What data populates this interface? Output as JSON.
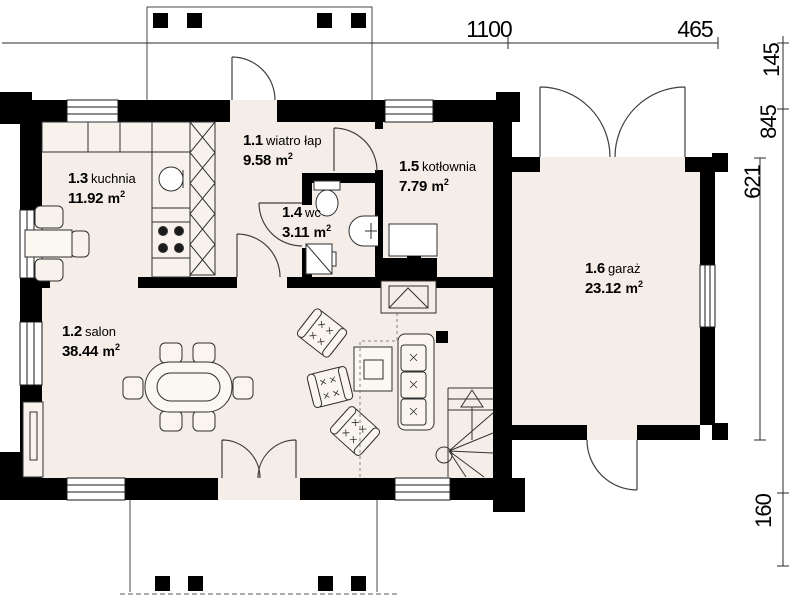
{
  "plan": {
    "rooms": {
      "vestibule": {
        "number": "1.1",
        "name": "wiatro łap",
        "area": "9.58"
      },
      "salon": {
        "number": "1.2",
        "name": "salon",
        "area": "38.44"
      },
      "kitchen": {
        "number": "1.3",
        "name": "kuchnia",
        "area": "11.92"
      },
      "wc": {
        "number": "1.4",
        "name": "wc",
        "area": "3.11"
      },
      "boiler": {
        "number": "1.5",
        "name": "kotłownia",
        "area": "7.79"
      },
      "garage": {
        "number": "1.6",
        "name": "garaż",
        "area": "23.12"
      }
    },
    "unit": {
      "symbol": "m",
      "exponent": "2"
    },
    "dimensions": {
      "top": [
        "1100",
        "465"
      ],
      "right": [
        "145",
        "845",
        "621",
        "160"
      ]
    },
    "colors": {
      "wall": "#000000",
      "floor": "#f5eee8",
      "background": "#ffffff",
      "line": "#3a3a3a"
    }
  }
}
